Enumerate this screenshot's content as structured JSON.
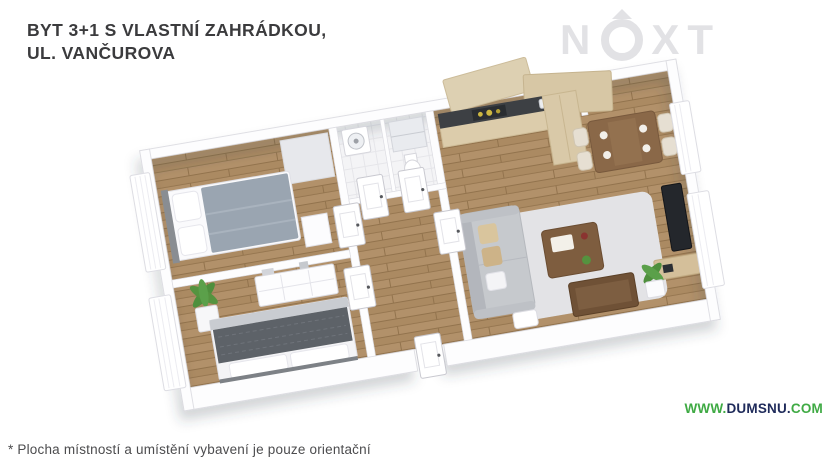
{
  "page": {
    "background_color": "#ffffff"
  },
  "header": {
    "title_line1": "BYT 3+1 S VLASTNÍ ZAHRÁDKOU,",
    "title_line2": "UL. VANČUROVA",
    "title_color": "#3b3b3d"
  },
  "watermark": {
    "brand": "NEXT",
    "letter_n": "N",
    "letter_x": "X",
    "letter_t": "T",
    "color": "#e2e2e5"
  },
  "floorplan": {
    "view": "3d-isometric",
    "rotation_deg": -9.7,
    "rooms_visible": [
      "bedroom-1",
      "bedroom-2",
      "bathroom",
      "wc",
      "hallway",
      "kitchen",
      "dining-area",
      "living-room"
    ],
    "colors": {
      "wall": "#fdfdfe",
      "floor_wood": "#ab8a62",
      "floor_wood_joint": "#92734d",
      "floor_bath": "#f4f4f6",
      "blanket_light": "#9aa5b1",
      "blanket_dark": "#5d6268",
      "sofa": "#c6c9cd",
      "pillow_beige": "#d9c59d",
      "kitchen_cabinet": "#d9c9a8",
      "countertop": "#3d4044",
      "stove_burner": "#cdb741",
      "dining_table": "#8a6848",
      "coffee_table": "#7e5d3f",
      "tv": "#24272c",
      "media_shelf": "#d4bf9a",
      "plant": "#4e8f3d",
      "rug": "#e3e3e6"
    }
  },
  "footer": {
    "disclaimer": "* Plocha místností a umístění vybavení je pouze orientační",
    "website": {
      "prefix": "WWW.",
      "name": "DUMSNU.",
      "tld": "COM",
      "prefix_color": "#3faa44",
      "name_color": "#1e2a5a",
      "tld_color": "#3faa44"
    }
  }
}
